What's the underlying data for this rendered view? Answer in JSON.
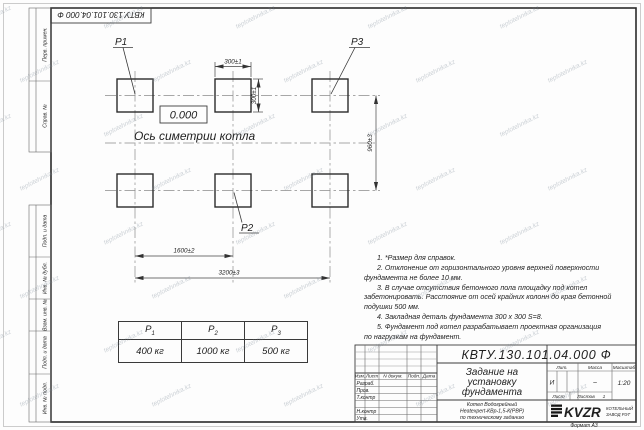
{
  "watermark": {
    "text": "teplotehnika.kz"
  },
  "sheet": {
    "top_doc_number": "КВТУ.130.101.04.000 Ф",
    "format_label": "Формат А3",
    "left_column_labels": [
      "Перв. примен.",
      "Справ. №",
      "Подп. и дата",
      "Инв. № дубл.",
      "Взам. инв. №",
      "Подп. и дата",
      "Инв. № подл."
    ]
  },
  "drawing": {
    "pads": {
      "p1": "P1",
      "p2": "P2",
      "p3": "P3"
    },
    "elevation_mark": "0.000",
    "axis_label": "Ось симетрии котла",
    "dimensions": {
      "pad_width": "300±1",
      "pad_height": "300±1",
      "row_spacing": "960±3",
      "col_spacing": "1600±2",
      "total_span": "3200±3"
    }
  },
  "notes": {
    "lines": [
      "1. *Размер для справок.",
      "2. Отклонение от горизонтального уровня верхней поверхности",
      "фундамента не более 10 мм.",
      "3. В случае отсутствия бетонного пола площадку под котел",
      "забетонировать. Расстояние от осей крайних колонн до края бетонной",
      "подушки 500 мм.",
      "4. Закладная деталь фундамента 300 х 300 S=8.",
      "5. Фундамент под котел разрабатывает проектная организация",
      "по нагрузкам на фундамент."
    ]
  },
  "load_table": {
    "headers": [
      {
        "base": "P",
        "sub": "1"
      },
      {
        "base": "P",
        "sub": "2"
      },
      {
        "base": "P",
        "sub": "3"
      }
    ],
    "values": [
      "400 кг",
      "1000 кг",
      "500 кг"
    ]
  },
  "stamp": {
    "doc_number": "КВТУ.130.101.04.000 Ф",
    "title_lines": [
      "Задание на",
      "установку",
      "фундамента"
    ],
    "product_lines": [
      "Котел Водогрейный",
      "Heatexpert-КВр-1,5-К(РВР)",
      "по техническому заданию"
    ],
    "header_cols": [
      "Изм.",
      "Лист",
      "N докум.",
      "Подп.",
      "Дата"
    ],
    "row_labels": [
      "Разраб.",
      "Пров.",
      "Т.контр",
      "Н.контр",
      "Утв."
    ],
    "lit": {
      "label": "Лит.",
      "value": "И"
    },
    "mass": {
      "label": "Масса",
      "value": "–"
    },
    "scale": {
      "label": "Масштаб",
      "value": "1:20"
    },
    "sheet_col": {
      "label": "Лист"
    },
    "sheets_col": {
      "label": "Листов",
      "value": "1"
    },
    "logo": {
      "text": "KVZR",
      "caption_lines": [
        "КОТЕЛЬНЫЙ",
        "ЗАВОД РЭТ"
      ]
    }
  }
}
